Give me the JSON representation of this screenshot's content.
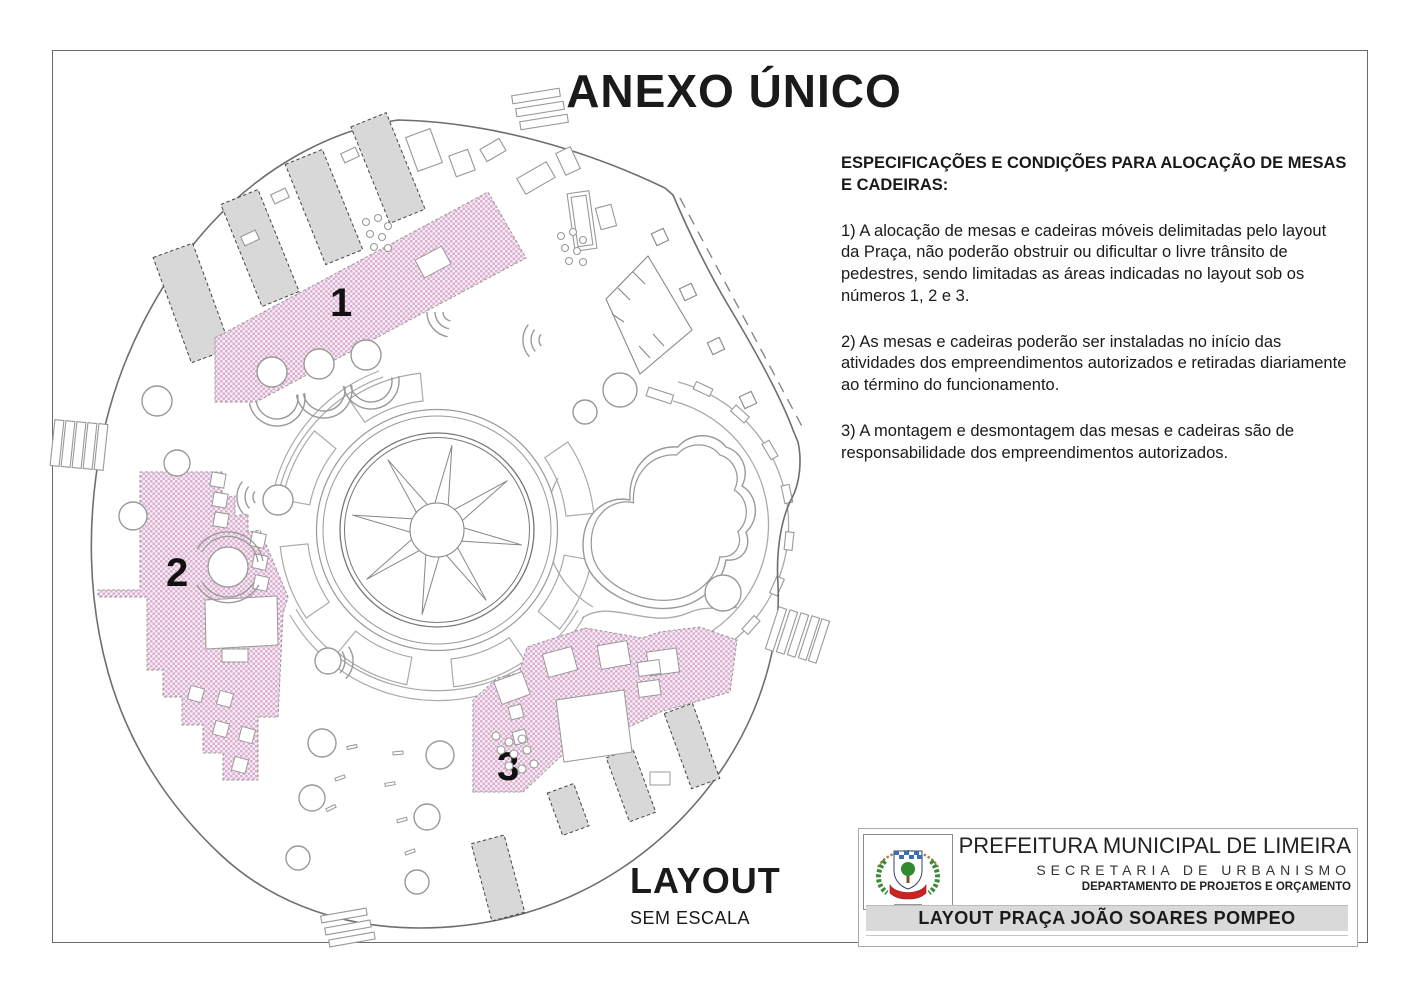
{
  "page": {
    "title": "ANEXO ÚNICO"
  },
  "specs": {
    "heading": "ESPECIFICAÇÕES E CONDIÇÕES PARA ALOCAÇÃO DE MESAS E CADEIRAS:",
    "items": [
      "1) A alocação de mesas e cadeiras móveis delimitadas pelo layout da Praça, não poderão obstruir ou dificultar o livre trânsito de pedestres, sendo limitadas as áreas indicadas no layout sob os números 1, 2 e 3.",
      "2) As mesas e cadeiras poderão ser instaladas no início das atividades dos empreendimentos autorizados e retiradas diariamente ao término do funcionamento.",
      "3) A montagem e desmontagem das mesas e cadeiras são de responsabilidade dos empreendimentos autorizados."
    ]
  },
  "plan": {
    "caption_title": "LAYOUT",
    "caption_subtitle": "SEM ESCALA",
    "area_labels": [
      "1",
      "2",
      "3"
    ],
    "colors": {
      "area_fill_light": "#f8eef5",
      "area_dot": "#dcaed0",
      "strip_fill": "#d8d8d8",
      "line": "#999999",
      "boundary": "#6e6e6e"
    }
  },
  "title_block": {
    "org": "PREFEITURA MUNICIPAL DE LIMEIRA",
    "dept1": "SECRETARIA DE URBANISMO",
    "dept2": "DEPARTAMENTO DE PROJETOS E ORÇAMENTO",
    "drawing_title": "LAYOUT PRAÇA JOÃO SOARES POMPEO",
    "logo": "brasao-limeira"
  }
}
